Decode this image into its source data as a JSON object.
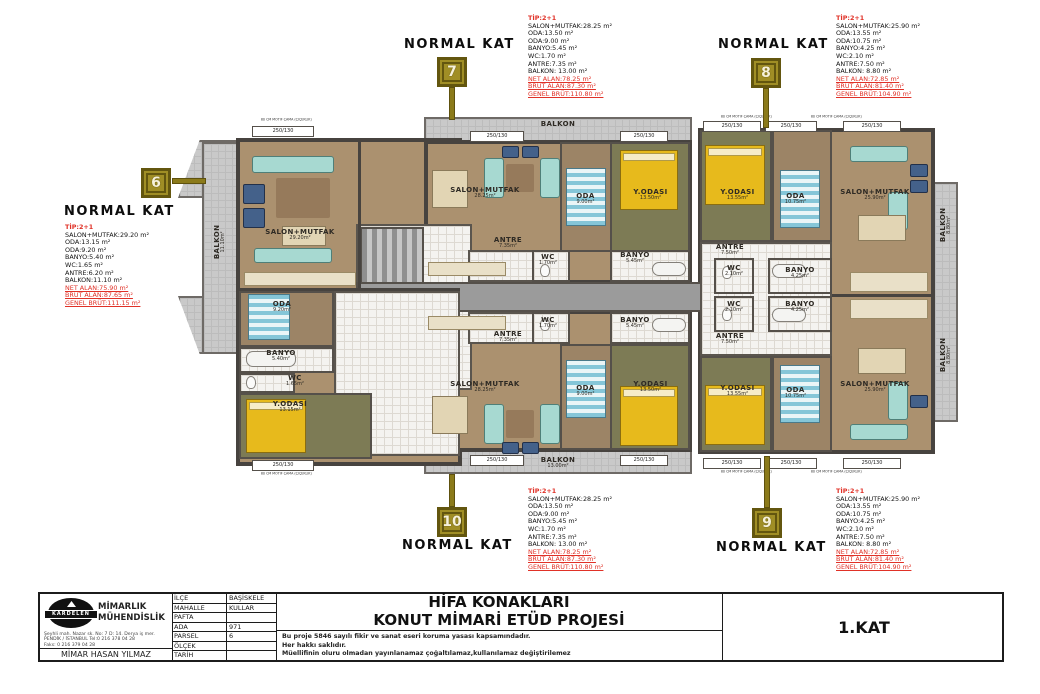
{
  "units": [
    {
      "number": "6",
      "kat_label": "NORMAL KAT",
      "tip": "TİP:2+1",
      "lines": [
        "SALON+MUTFAK:29.20 m²",
        "ODA:13.15 m²",
        "ODA:9.20 m²",
        "BANYO:5.40 m²",
        "WC:1.65 m²",
        "ANTRE:6.20 m²",
        "BALKON:11.10 m²"
      ],
      "red_lines": [
        "NET ALAN:75.90 m²",
        "BRÜT ALAN:87.65 m²",
        "GENEL BRÜT:111.15 m²"
      ]
    },
    {
      "number": "7",
      "kat_label": "NORMAL KAT",
      "tip": "TİP:2+1",
      "lines": [
        "SALON+MUTFAK:28.25 m²",
        "ODA:13.50 m²",
        "ODA:9.00 m²",
        "BANYO:5.45 m²",
        "WC:1.70 m²",
        "ANTRE:7.35 m²",
        "BALKON: 13.00 m²"
      ],
      "red_lines": [
        "NET ALAN:78.25 m²",
        "BRÜT ALAN:87.30 m²",
        "GENEL BRÜT:110.80 m²"
      ]
    },
    {
      "number": "8",
      "kat_label": "NORMAL KAT",
      "tip": "TİP:2+1",
      "lines": [
        "SALON+MUTFAK:25.90 m²",
        "ODA:13.55 m²",
        "ODA:10.75 m²",
        "BANYO:4.25 m²",
        "WC:2.10 m²",
        "ANTRE:7.50 m²",
        "BALKON: 8.80 m²"
      ],
      "red_lines": [
        "NET ALAN:72.85 m²",
        "BRÜT ALAN:81.40 m²",
        "GENEL BRÜT:104.90 m²"
      ]
    },
    {
      "number": "10",
      "kat_label": "NORMAL KAT",
      "tip": "TİP:2+1",
      "lines": [
        "SALON+MUTFAK:28.25 m²",
        "ODA:13.50 m²",
        "ODA:9.00 m²",
        "BANYO:5.45 m²",
        "WC:1.70 m²",
        "ANTRE:7.35 m²",
        "BALKON: 13.00 m²"
      ],
      "red_lines": [
        "NET ALAN:78.25 m²",
        "BRÜT ALAN:87.30 m²",
        "GENEL BRÜT:110.80 m²"
      ]
    },
    {
      "number": "9",
      "kat_label": "NORMAL KAT",
      "tip": "TİP:2+1",
      "lines": [
        "SALON+MUTFAK:25.90 m²",
        "ODA:13.55 m²",
        "ODA:10.75 m²",
        "BANYO:4.25 m²",
        "WC:2.10 m²",
        "ANTRE:7.50 m²",
        "BALKON: 8.80 m²"
      ],
      "red_lines": [
        "NET ALAN:72.85 m²",
        "BRÜT ALAN:81.40 m²",
        "GENEL BRÜT:104.90 m²"
      ]
    }
  ],
  "plan_labels": [
    {
      "text": "BALKON",
      "area": "11.10m²"
    },
    {
      "text": "SALON+MUTFAK",
      "area": "29.20m²"
    },
    {
      "text": "ODA",
      "area": "9.20m²"
    },
    {
      "text": "BANYO",
      "area": "5.40m²"
    },
    {
      "text": "WC",
      "area": "1.65m²"
    },
    {
      "text": "Y.ODASI",
      "area": "13.15m²"
    },
    {
      "text": "BALKON",
      "area": "13.00m²"
    },
    {
      "text": "SALON+MUTFAK",
      "area": "28.25m²"
    },
    {
      "text": "ODA",
      "area": "9.00m²"
    },
    {
      "text": "Y.ODASI",
      "area": "13.50m²"
    },
    {
      "text": "ANTRE",
      "area": "7.35m²"
    },
    {
      "text": "WC",
      "area": "1.70m²"
    },
    {
      "text": "BANYO",
      "area": "5.45m²"
    },
    {
      "text": "Y.ODASI",
      "area": "13.55m²"
    },
    {
      "text": "ODA",
      "area": "10.75m²"
    },
    {
      "text": "SALON+MUTFAK",
      "area": "25.90m²"
    },
    {
      "text": "ANTRE",
      "area": "7.50m²"
    },
    {
      "text": "WC",
      "area": "2.10m²"
    },
    {
      "text": "BANYO",
      "area": "4.25m²"
    },
    {
      "text": "BALKON",
      "area": "8.80m²"
    },
    {
      "text": "ANTRE",
      "area": "7.50m²"
    },
    {
      "text": "WC",
      "area": "2.10m²"
    },
    {
      "text": "BANYO",
      "area": "4.25m²"
    },
    {
      "text": "Y.ODASI",
      "area": "13.55m²"
    },
    {
      "text": "ODA",
      "area": "10.75m²"
    },
    {
      "text": "SALON+MUTFAK",
      "area": "25.90m²"
    },
    {
      "text": "BALKON",
      "area": "8.80m²"
    },
    {
      "text": "ANTRE",
      "area": "7.35m²"
    },
    {
      "text": "WC",
      "area": "1.70m²"
    },
    {
      "text": "BANYO",
      "area": "5.45m²"
    },
    {
      "text": "SALON+MUTFAK",
      "area": "28.25m²"
    },
    {
      "text": "ODA",
      "area": "9.00m²"
    },
    {
      "text": "Y.ODASI",
      "area": "13.50m²"
    },
    {
      "text": "BALKON",
      "area": "13.00m²"
    }
  ],
  "annotations": {
    "dim_caption": "80 CM MOTİF ÇAMA (ÇİÇEKLİK)",
    "dim_value": "250/130"
  },
  "title_block": {
    "logo_text": "KARDELEN",
    "company_line1": "MİMARLIK",
    "company_line2": "MÜHENDİSLİK",
    "address_lines": [
      "Şeyhli mah. Nazar sk. No: 7 D: 14. Derya iş mer.",
      "PENDİK / İSTANBUL Tel:0 216 378 04 28",
      "Faks: 0 216 379 04 28"
    ],
    "architect": "MİMAR  HASAN YILMAZ",
    "fields": [
      {
        "label": "İLÇE",
        "value": "BAŞİSKELE"
      },
      {
        "label": "MAHALLE",
        "value": "KULLAR"
      },
      {
        "label": "PAFTA",
        "value": ""
      },
      {
        "label": "ADA",
        "value": "971"
      },
      {
        "label": "PARSEL",
        "value": "6"
      },
      {
        "label": "ÖLÇEK",
        "value": ""
      },
      {
        "label": "TARİH",
        "value": ""
      }
    ],
    "project_title": [
      "HİFA KONAKLARI",
      "KONUT MİMARİ ETÜD PROJESİ"
    ],
    "copyright": [
      "Bu proje 5846 sayılı fikir ve sanat eseri koruma yasası kapsamındadır.",
      "Her hakkı saklıdır.",
      "Müellifinin oluru olmadan yayınlanamaz çoğaltılamaz,kullanılamaz değiştirilemez"
    ],
    "floor": "1.KAT"
  },
  "colors": {
    "spec_red": "#e03127",
    "sign_gold": "#a08e25",
    "wall": "#47433f",
    "balcony_gray": "#c9c9c9",
    "corridor_gray": "#9b9b9b",
    "wood": "#ab916f",
    "olive": "#7d7b55",
    "bed_yellow": "#e7ba1c",
    "sofa_teal": "#a7d9d1"
  }
}
